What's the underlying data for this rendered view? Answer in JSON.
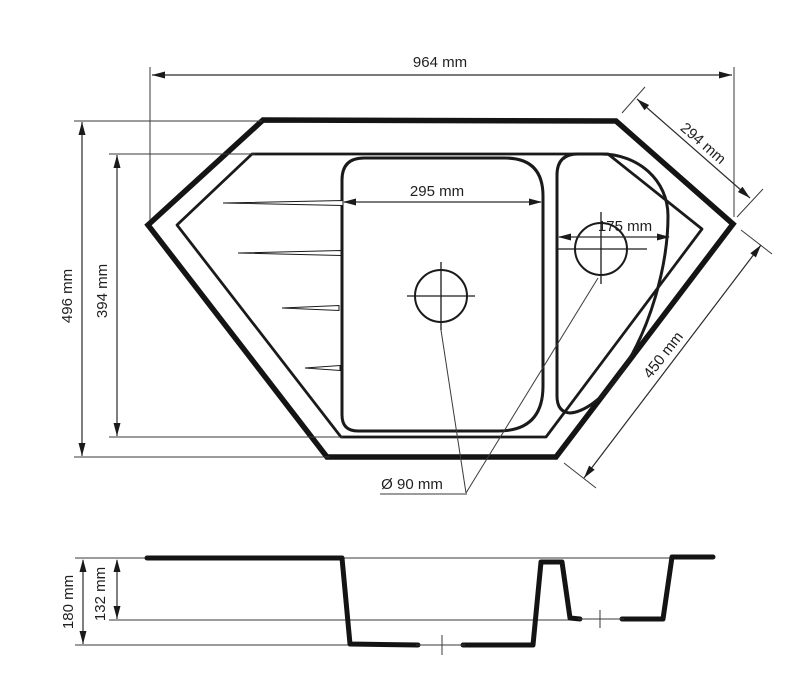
{
  "drawing": {
    "type": "technical-dimension-drawing",
    "subject": "corner kitchen sink, top view and section view",
    "units": "mm",
    "colors": {
      "line": "#141414",
      "text": "#1f1f1f",
      "background": "#ffffff"
    },
    "top_view": {
      "dimensions": {
        "overall_width": {
          "label": "964 mm"
        },
        "corner_edge": {
          "label": "294 mm"
        },
        "overall_depth": {
          "label": "496 mm"
        },
        "inner_rim_depth": {
          "label": "394 mm"
        },
        "main_bowl_width": {
          "label": "295 mm"
        },
        "small_bowl_width": {
          "label": "175 mm"
        },
        "diagonal_edge": {
          "label": "450 mm"
        },
        "drain_diameter": {
          "label": "Ø 90 mm"
        }
      },
      "features": [
        "outer outline",
        "inner rim",
        "main bowl",
        "small bowl",
        "drainboard grooves x4",
        "two drain holes"
      ]
    },
    "section_view": {
      "dimensions": {
        "main_bowl_depth": {
          "label": "180 mm"
        },
        "small_bowl_depth": {
          "label": "132 mm"
        }
      }
    }
  }
}
